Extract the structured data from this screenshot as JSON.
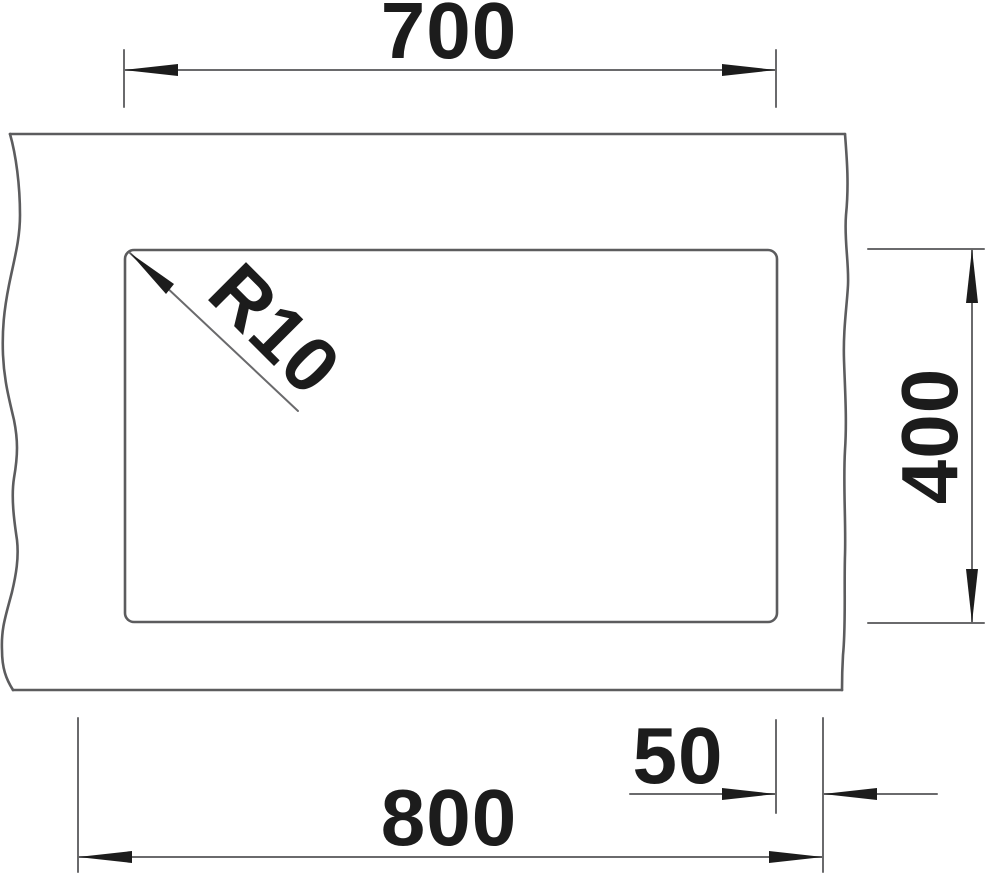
{
  "drawing": {
    "kind": "technical-dimension-drawing",
    "labels": {
      "top_width": "700",
      "right_height": "400",
      "bottom_width": "800",
      "bottom_offset": "50",
      "corner_radius": "R10"
    },
    "colors": {
      "outline": "#5c5c5e",
      "dimension": "#6a6a6c",
      "ink": "#1c1c1c",
      "background": "#ffffff"
    }
  }
}
